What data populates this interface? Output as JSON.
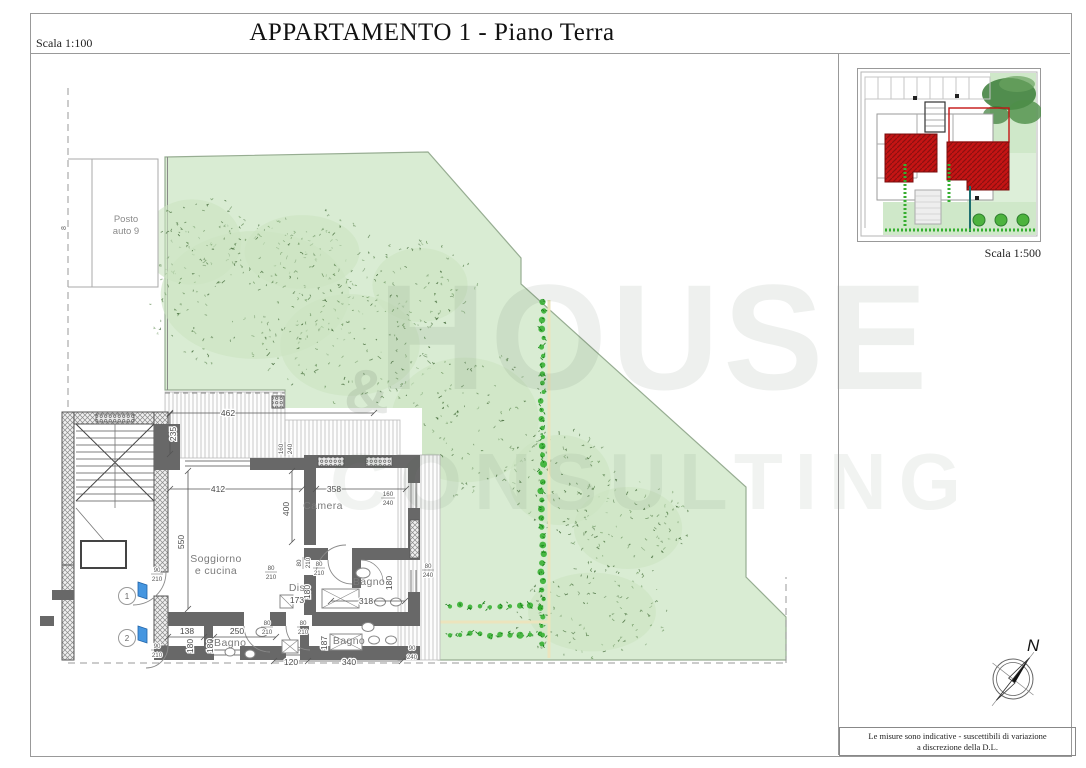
{
  "sheet": {
    "title": "APPARTAMENTO 1 - Piano Terra",
    "scale_main": "Scala 1:100",
    "scale_inset": "Scala 1:500",
    "disclaimer_line1": "Le misure sono indicative - suscettibili di variazione",
    "disclaimer_line2": "a discrezione della D.L.",
    "compass_north": "N"
  },
  "watermark": {
    "word1": "HOUSE",
    "amp": "&",
    "word2": "CONSULTING"
  },
  "rooms": {
    "soggiorno_line1": "Soggiorno",
    "soggiorno_line2": "e cucina",
    "camera": "Camera",
    "dis": "Dis",
    "bagno": "Bagno",
    "bagno_service": "*Bagno",
    "parking_line1": "Posto",
    "parking_line2": "auto 9"
  },
  "markers": {
    "door1": "1",
    "door2": "2",
    "left_dim": "8"
  },
  "dims": {
    "d462": "462",
    "d235": "235",
    "d412": "412",
    "d358": "358",
    "d400": "400",
    "d550": "550",
    "d173": "173",
    "d318": "318",
    "d138": "138",
    "d250": "250",
    "d120": "120",
    "d340": "340",
    "d180": "180",
    "d187": "187"
  },
  "nums": {
    "n80": "80",
    "n90": "90",
    "n160": "160",
    "n210": "210",
    "n240": "240"
  },
  "colors": {
    "garden": "#d9ecd3",
    "tree_dark": "#4f7347",
    "hedge": "#2fae2a",
    "wall": "#686868",
    "roof_red": "#c41414",
    "door_blue": "#4596e0"
  }
}
